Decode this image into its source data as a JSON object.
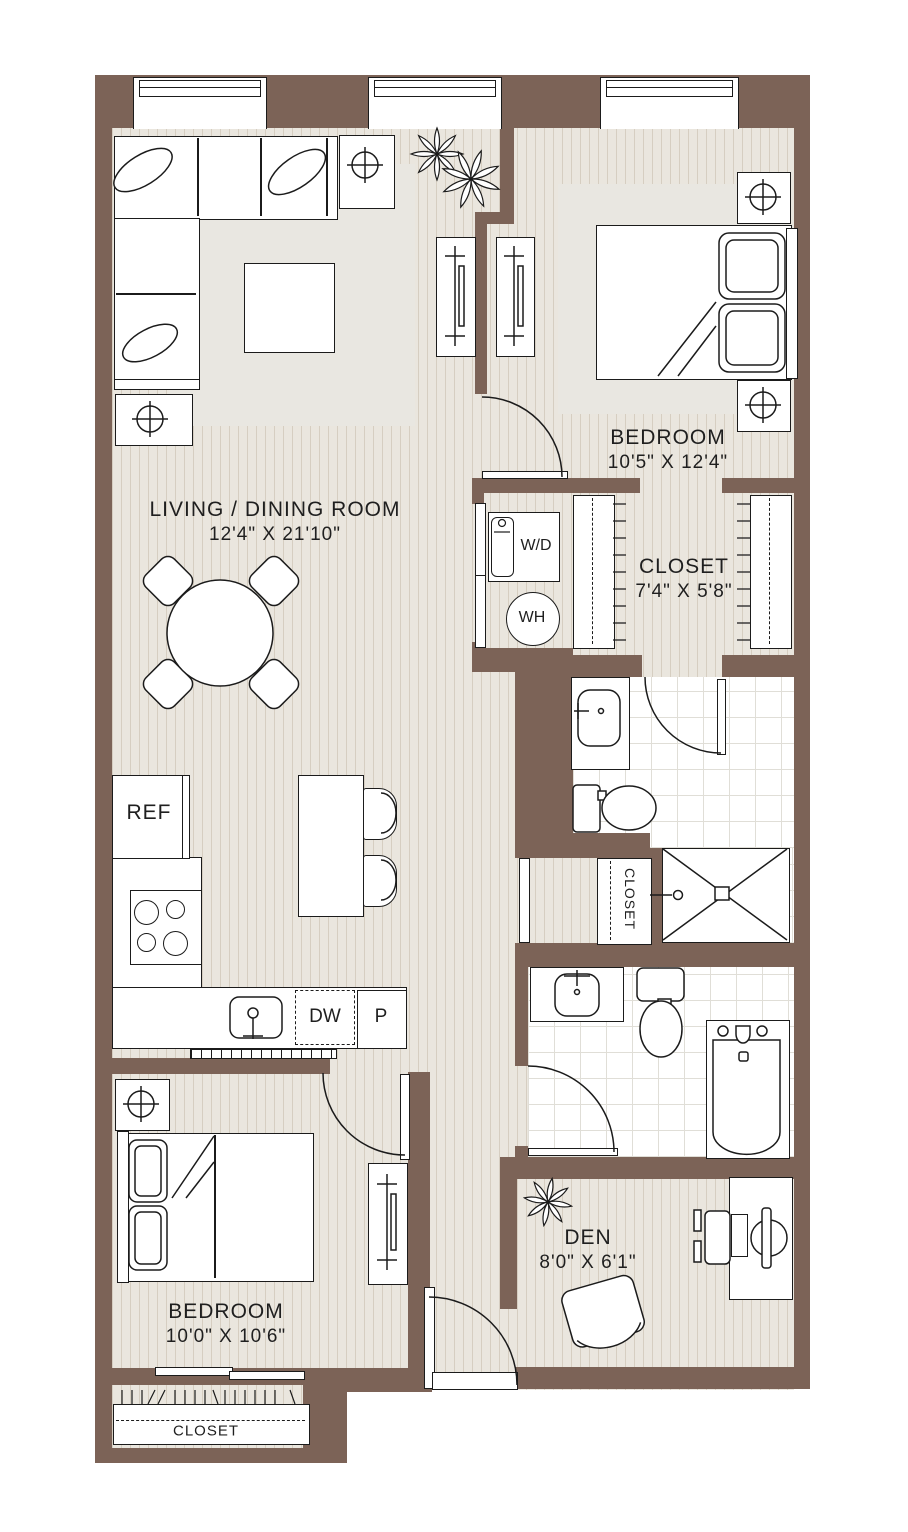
{
  "plan": {
    "title": "2 bed / 2 bath + den apartment floor plan",
    "colors": {
      "wall": "#7c6357",
      "floor": "#eae6de",
      "floor_stripe": "#d6cec1",
      "rug": "#e9e7e1",
      "tile_line": "#e0ded7",
      "outline": "#1b1b1b",
      "ink": "#1f1f1f"
    },
    "rooms": {
      "living": {
        "name": "LIVING / DINING ROOM",
        "dims": "12'4\" X 21'10\""
      },
      "bedroom1": {
        "name": "BEDROOM",
        "dims": "10'5\" X 12'4\""
      },
      "walk_in_closet": {
        "name": "CLOSET",
        "dims": "7'4\" X 5'8\""
      },
      "bedroom2": {
        "name": "BEDROOM",
        "dims": "10'0\" X 10'6\""
      },
      "den": {
        "name": "DEN",
        "dims": "8'0\" X 6'1\""
      }
    },
    "fixtures": {
      "refrigerator": "REF",
      "dishwasher": "DW",
      "pantry": "P",
      "washer_dryer": "W/D",
      "water_heater": "WH",
      "hall_closet": "CLOSET",
      "bedroom2_closet": "CLOSET"
    }
  }
}
